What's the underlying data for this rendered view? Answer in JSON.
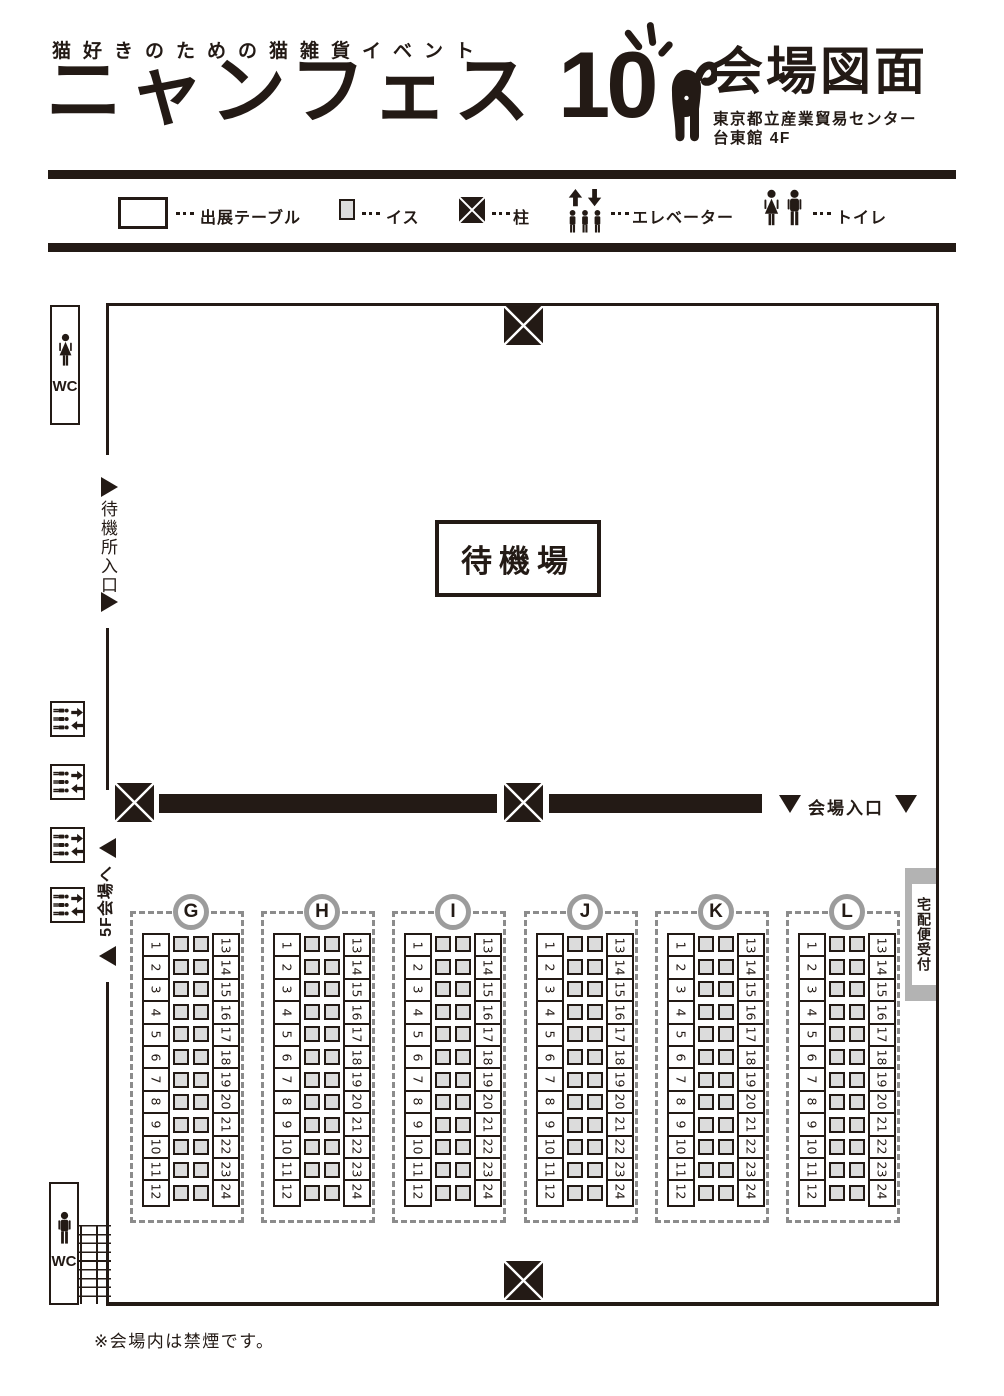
{
  "header": {
    "tagline": "猫好きのための猫雑貨イベント",
    "title": "ニャンフェス",
    "edition": "10",
    "map_title": "会場図面",
    "venue_name": "東京都立産業貿易センター",
    "venue_floor": "台東館 4F"
  },
  "legend": {
    "items": [
      {
        "icon": "table-swatch",
        "label": "出展テーブル"
      },
      {
        "icon": "chair-swatch",
        "label": "イス"
      },
      {
        "icon": "pillar-swatch",
        "label": "柱"
      },
      {
        "icon": "elevator-icon",
        "label": "エレベーター"
      },
      {
        "icon": "toilet-icon",
        "label": "トイレ"
      }
    ]
  },
  "plan": {
    "wc_label": "WC",
    "waiting_entrance_label": "待機所入口",
    "waiting_area_label": "待機場",
    "hall_entrance_label": "会場入口",
    "to_5f_label": "5F会場へ",
    "delivery_label": "宅配便受付",
    "no_smoking_note": "※会場内は禁煙です。",
    "blocks": [
      {
        "label": "G"
      },
      {
        "label": "H"
      },
      {
        "label": "I"
      },
      {
        "label": "J"
      },
      {
        "label": "K"
      },
      {
        "label": "L"
      }
    ],
    "block_lefts": [
      130,
      261,
      392,
      524,
      655,
      786
    ],
    "table_numbers_left": [
      "1",
      "2",
      "3",
      "4",
      "5",
      "6",
      "7",
      "8",
      "9",
      "10",
      "11",
      "12"
    ],
    "table_numbers_right": [
      "13",
      "14",
      "15",
      "16",
      "17",
      "18",
      "19",
      "20",
      "21",
      "22",
      "23",
      "24"
    ]
  },
  "colors": {
    "ink": "#231a15",
    "chair_fill": "#dcdcdc",
    "dash_gray": "#8c8c8c",
    "ring_gray": "#9c9c9c",
    "delivery_gray": "#b3b3b3"
  }
}
